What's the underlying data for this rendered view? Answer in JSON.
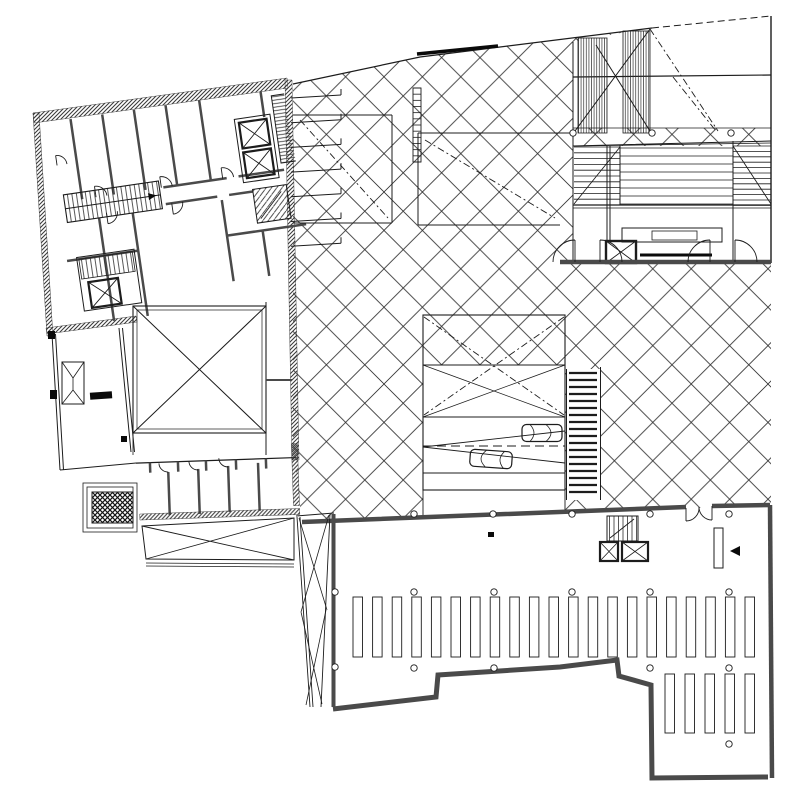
{
  "document": {
    "title": "Ground floor plan",
    "medium": "scanned ink line drawing"
  },
  "colors": {
    "paper": "#ffffff",
    "ink": "#1c1c1c",
    "wall_poche": "#4a4a4a",
    "hatch": "#2e2e2e",
    "black_fill": "#0a0a0a"
  },
  "markers": {
    "section_arrow_glyph": "◀"
  },
  "plan": {
    "skylight_row1": {
      "x0": 353,
      "pitch": 19.6,
      "count": 21,
      "w": 9.5,
      "y": 597,
      "h": 60
    },
    "skylight_row2": {
      "x0": 665,
      "pitch": 20,
      "count": 5,
      "w": 9.5,
      "y": 674,
      "h": 59
    },
    "column_radius": 3.2,
    "columns": [
      [
        414,
        514
      ],
      [
        493,
        514
      ],
      [
        572,
        514
      ],
      [
        650,
        514
      ],
      [
        729,
        514
      ],
      [
        335,
        592
      ],
      [
        414,
        592
      ],
      [
        494,
        592
      ],
      [
        572,
        592
      ],
      [
        650,
        592
      ],
      [
        729,
        592
      ],
      [
        335,
        667
      ],
      [
        414,
        668
      ],
      [
        494,
        668
      ],
      [
        650,
        668
      ],
      [
        729,
        668
      ],
      [
        729,
        744
      ],
      [
        573,
        133
      ],
      [
        652,
        133
      ],
      [
        731,
        133
      ]
    ],
    "crosswalk": {
      "x": 569,
      "w": 28,
      "y0": 373,
      "count": 18,
      "pitch": 7
    },
    "tick_lines": {
      "x": 291,
      "len": 50,
      "y0": 98,
      "pitch": 24.7,
      "count": 7,
      "drop": 3
    },
    "seat_blocks": [
      {
        "x": 574,
        "x2": 620,
        "y0": 147,
        "pitch": 5.8,
        "count": 11
      },
      {
        "x": 620,
        "x2": 733,
        "y0": 148,
        "pitch": 8,
        "count": 8
      },
      {
        "x": 733,
        "x2": 771,
        "y0": 146,
        "pitch": 5.4,
        "count": 12
      }
    ],
    "vband1": {
      "x": 578,
      "x2": 607,
      "pitch": 2.6,
      "y": 38,
      "y2": 133
    },
    "vband2": {
      "x": 623,
      "x2": 650,
      "pitch": 2.6,
      "y": 31,
      "y2": 133
    },
    "ladder": {
      "x": 413,
      "w": 8,
      "y0": 88,
      "h": 74,
      "rungs": 12
    }
  }
}
